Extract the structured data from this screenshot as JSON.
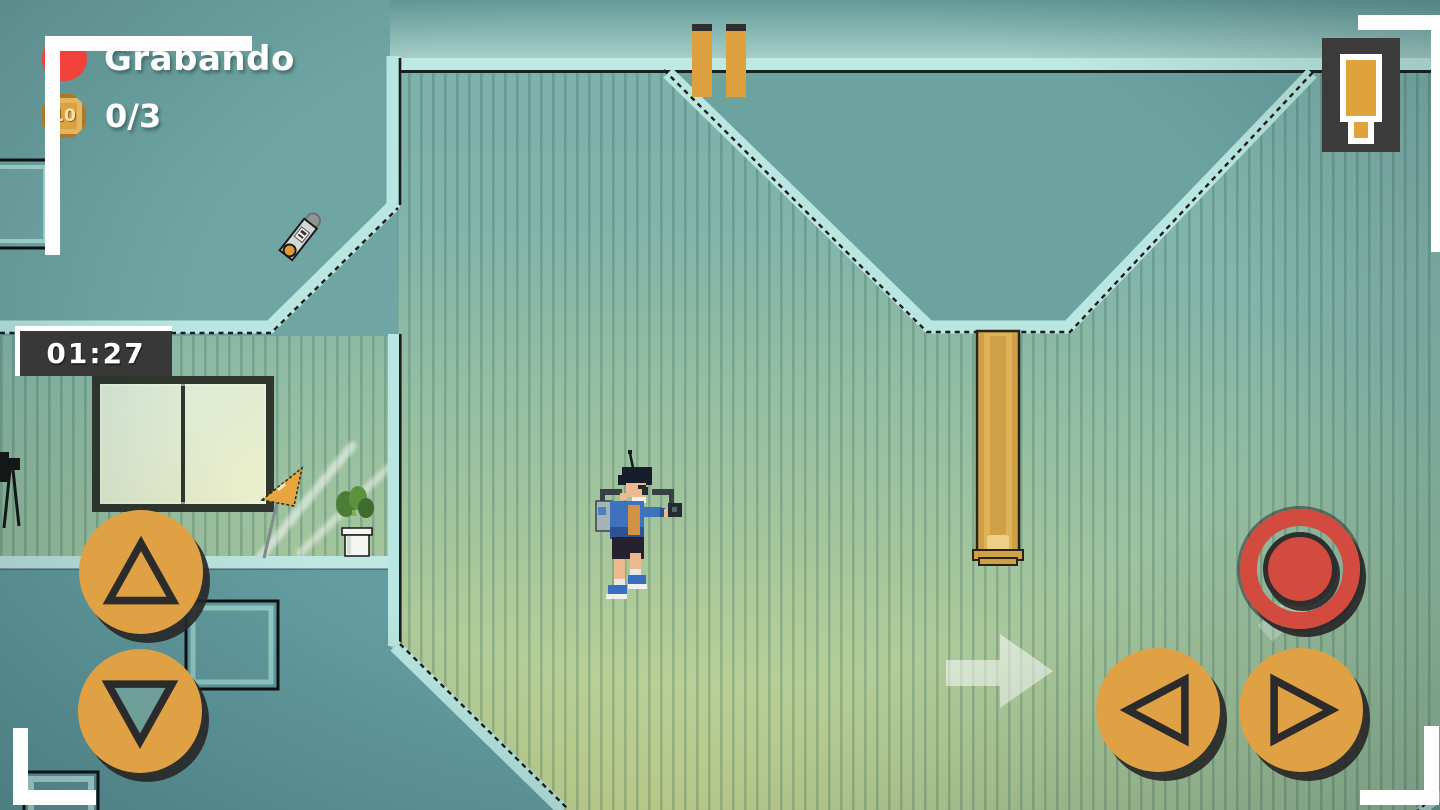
{
  "hud": {
    "recording_label": "Grabando",
    "coin_icon_value": "10",
    "coin_counter": "0/3",
    "timer": "01:27"
  },
  "icons": {
    "record_dot": "red-circle",
    "coin": "gold-coin",
    "pause": "two-vertical-bars",
    "item_slot_key": "orange-key",
    "jump": "triangle-up",
    "crouch": "triangle-down",
    "move_left": "triangle-left",
    "move_right": "triangle-right",
    "record_action": "red-ring-dot",
    "hint_arrow": "arrow-right",
    "viewfinder": "corner-brackets"
  },
  "scene": {
    "character": "pixel-character-jumping",
    "collectible": "recorder-gadget-pickup",
    "decor": [
      "window",
      "pennant-flag",
      "potted-plant",
      "camera-tripod",
      "hanging-pole",
      "wall-frames",
      "light-streaks"
    ]
  },
  "colors": {
    "button_orange": "#e0a144",
    "record_red": "#d24b3e",
    "rec_dot_red": "#f2413a",
    "hard_shadow": "#2c2c2c",
    "outside_teal": "#6fa6a4",
    "wall_teal": "#7db1ab",
    "spotlight_green": "#dce28c",
    "edge_highlight": "#b9e6e0",
    "panel_dark": "#383838",
    "hud_white": "#ffffff"
  }
}
